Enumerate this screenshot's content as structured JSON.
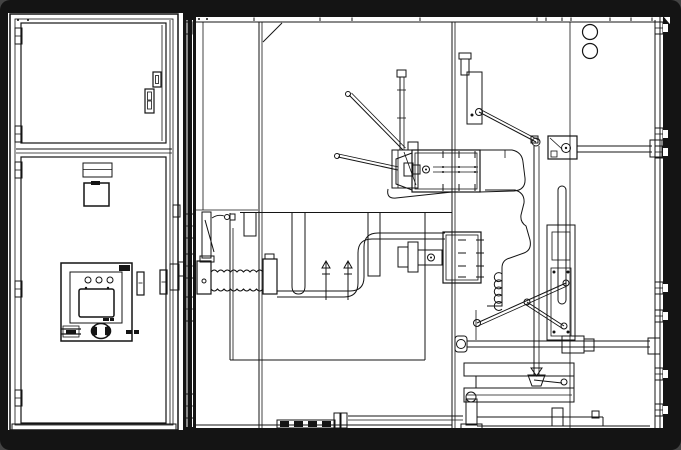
{
  "meta": {
    "kind": "technical-line-drawing",
    "subject": "medium-voltage-switchgear-cabinet-cutaway",
    "views": [
      "front-view-left-cabinet",
      "side-section-view-right"
    ]
  },
  "colors": {
    "background": "#000000",
    "paper": "#ffffff",
    "line": "#141414"
  },
  "left_cabinet": {
    "upper_door": {
      "hinges_y": [
        28,
        126
      ]
    },
    "lower_door": {
      "hinges_y": [
        162,
        281,
        390
      ]
    },
    "control_panel": {
      "led_xy": [
        [
          88,
          280
        ],
        [
          99,
          280
        ],
        [
          110,
          280
        ]
      ],
      "led_radius": 3,
      "pilot_dots": [
        [
          86,
          288
        ],
        [
          108,
          288
        ]
      ],
      "has_screen": true,
      "has_knob": true
    }
  },
  "middle_section": {
    "top_tick_x": [
      254,
      320,
      352,
      420,
      537,
      546,
      562,
      571,
      610,
      631,
      652
    ],
    "top_dot_x": [
      664
    ],
    "panel_dots": [
      [
        199,
        19
      ],
      [
        207,
        19
      ],
      [
        18,
        20
      ],
      [
        28,
        20
      ]
    ],
    "door_hardware_y": [
      214,
      254,
      297,
      394
    ],
    "clamp_x": [
      326,
      348
    ],
    "corrugated_tube": {
      "x0": 211,
      "x1": 263,
      "y_top": 272,
      "y_bot": 289,
      "pitch": 6.5
    },
    "bushing_bolt_cols_upper_x": [
      443,
      459,
      475
    ],
    "bushing_bolt_rows_lower_y": [
      240,
      253,
      266,
      277
    ]
  },
  "right_section": {
    "vent_holes": [
      {
        "cx": 590,
        "cy": 32,
        "r": 7.5
      },
      {
        "cx": 590,
        "cy": 51,
        "r": 7.5
      }
    ],
    "wall_bolts_y": [
      22,
      128,
      146,
      282,
      310,
      368,
      404
    ],
    "bellows": {
      "x": 498,
      "y0": 274,
      "y1": 306,
      "r": 4.5
    },
    "rail_dashes": {
      "x0": 280,
      "x1": 332,
      "y": 421,
      "h": 6,
      "w": 9,
      "gap": 5
    }
  }
}
